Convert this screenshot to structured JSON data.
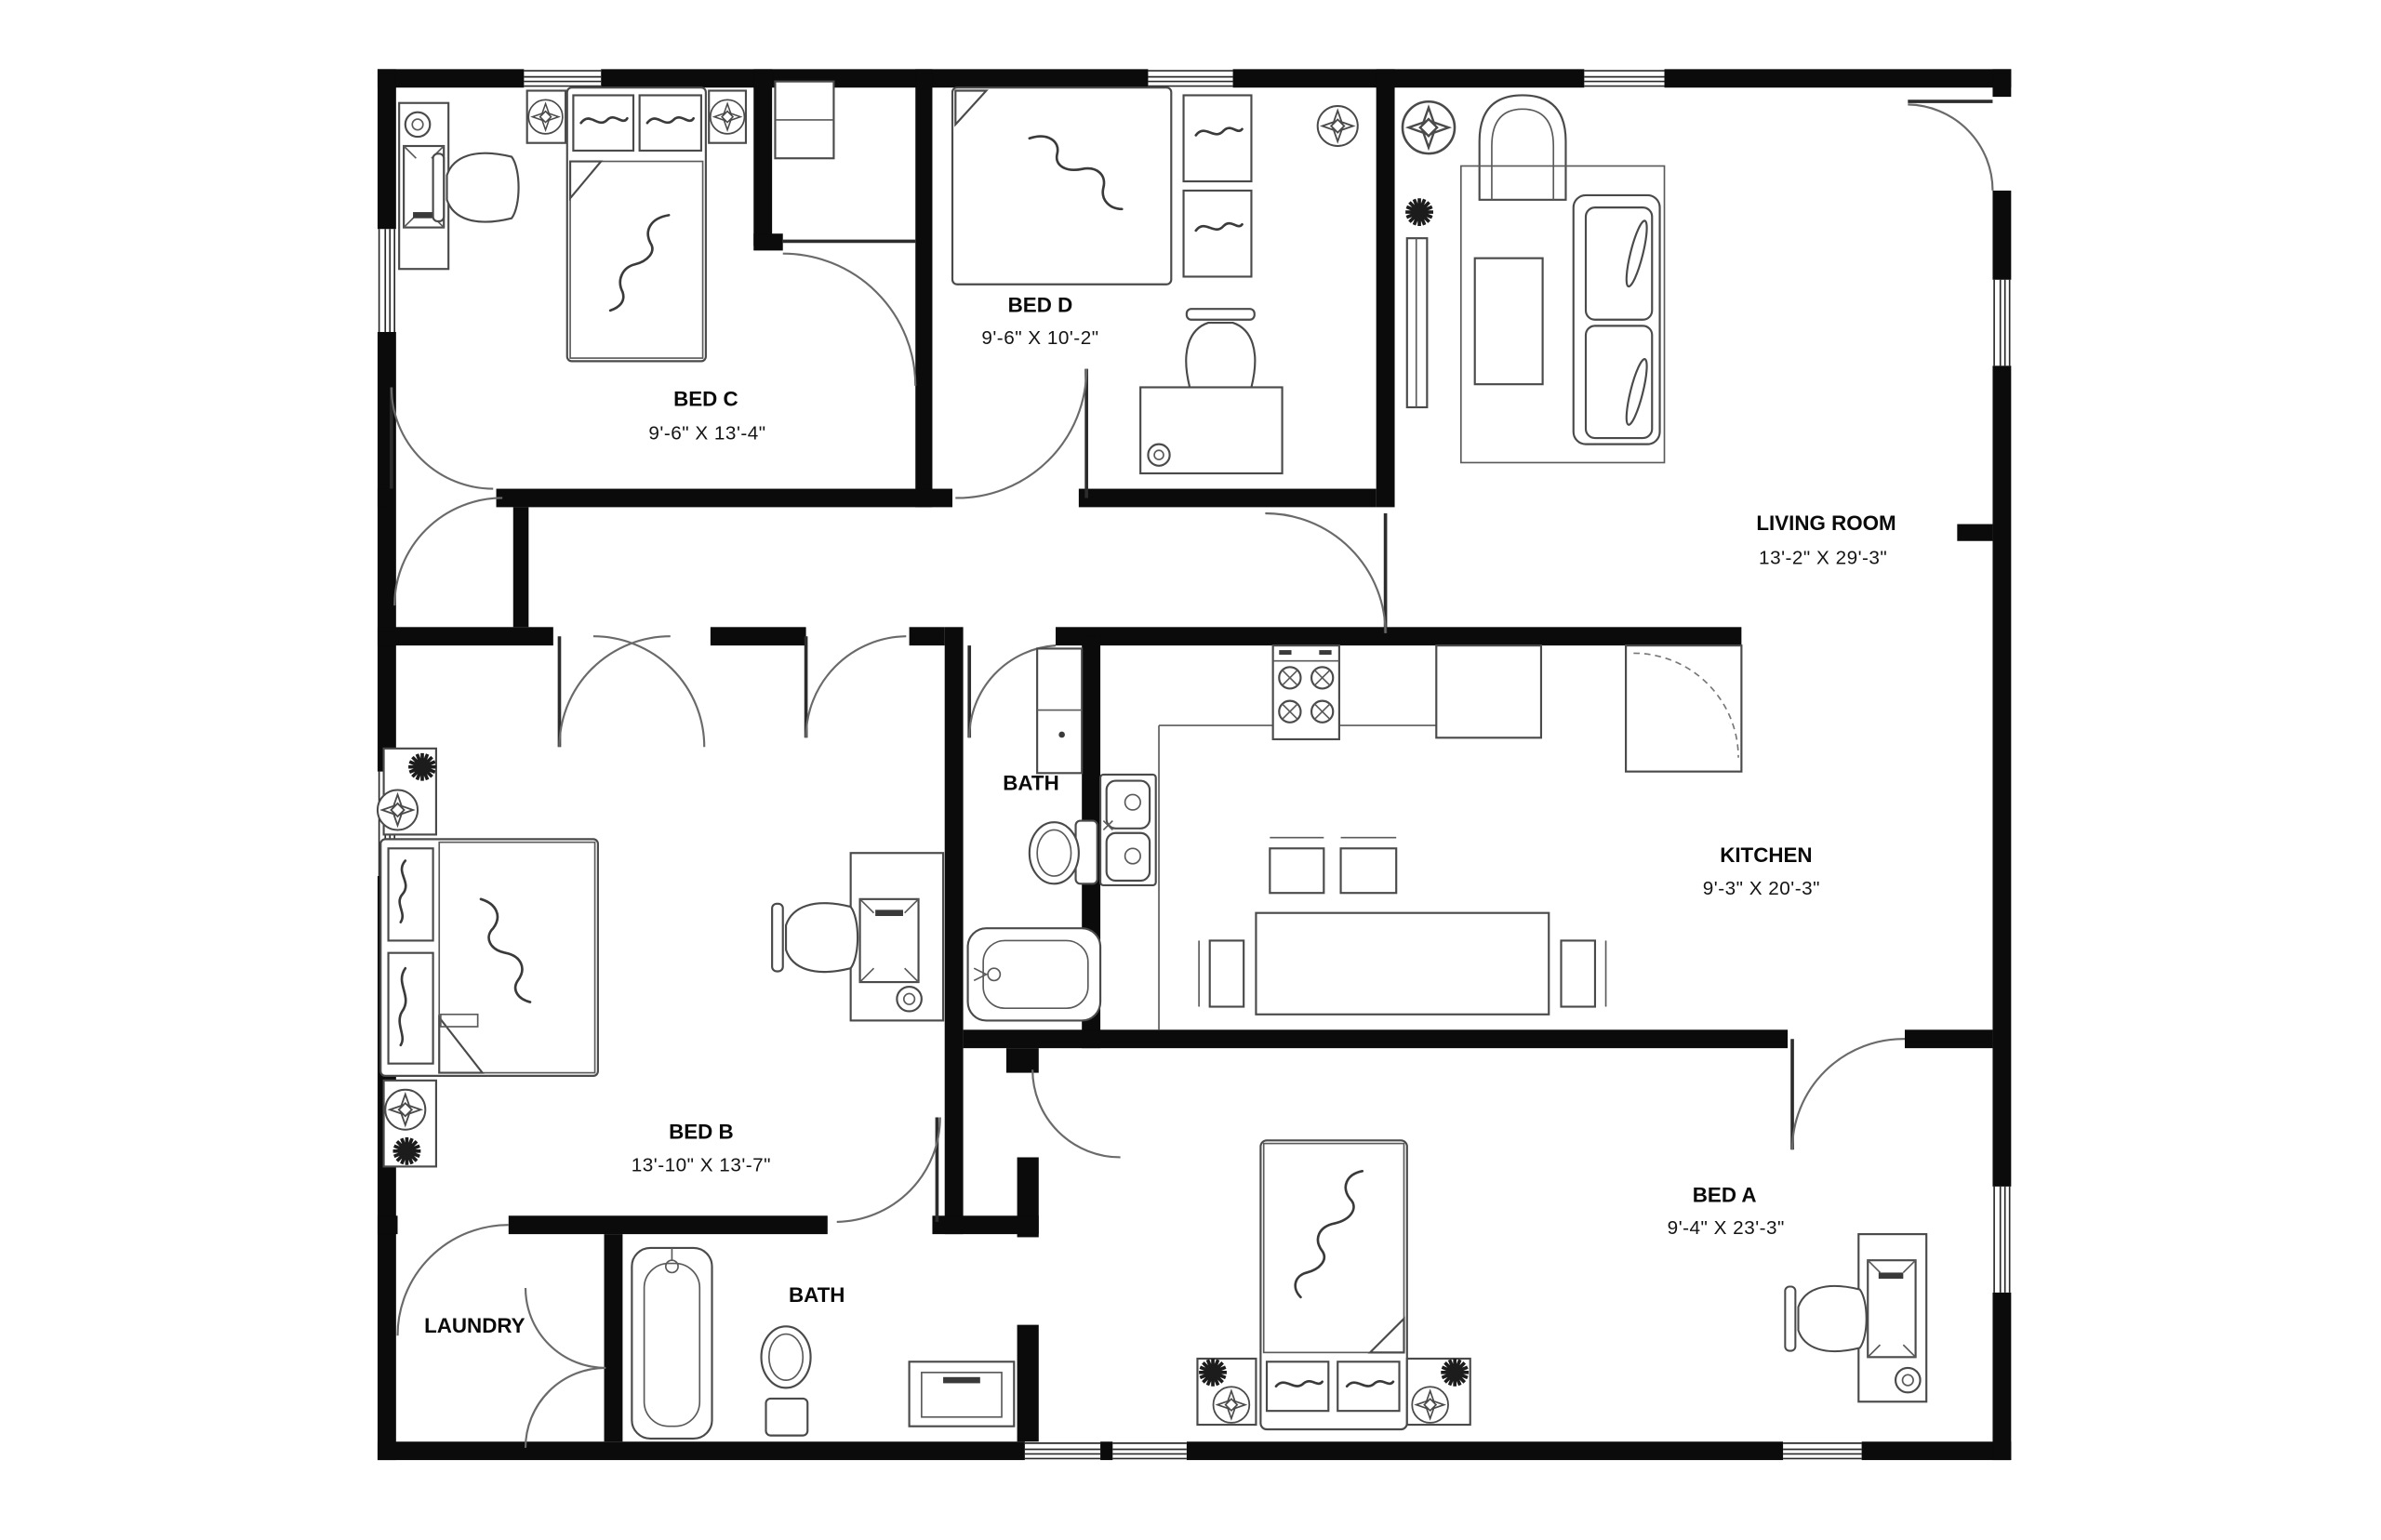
{
  "floor_plan": {
    "rooms": [
      {
        "id": "bed-c",
        "name": "BED C",
        "dims": "9'-6\" X 13'-4\""
      },
      {
        "id": "bed-d",
        "name": "BED D",
        "dims": "9'-6\" X 10'-2\""
      },
      {
        "id": "living-room",
        "name": "LIVING ROOM",
        "dims": "13'-2\" X 29'-3\""
      },
      {
        "id": "kitchen",
        "name": "KITCHEN",
        "dims": "9'-3\" X 20'-3\""
      },
      {
        "id": "bed-b",
        "name": "BED B",
        "dims": "13'-10\" X 13'-7\""
      },
      {
        "id": "bed-a",
        "name": "BED A",
        "dims": "9'-4\" X 23'-3\""
      },
      {
        "id": "bath-upper",
        "name": "BATH",
        "dims": ""
      },
      {
        "id": "bath-lower",
        "name": "BATH",
        "dims": ""
      },
      {
        "id": "laundry",
        "name": "LAUNDRY",
        "dims": ""
      }
    ],
    "colors": {
      "wall": "#0b0b0b",
      "background": "#ffffff",
      "furniture_line": "#4a4a4a"
    }
  }
}
